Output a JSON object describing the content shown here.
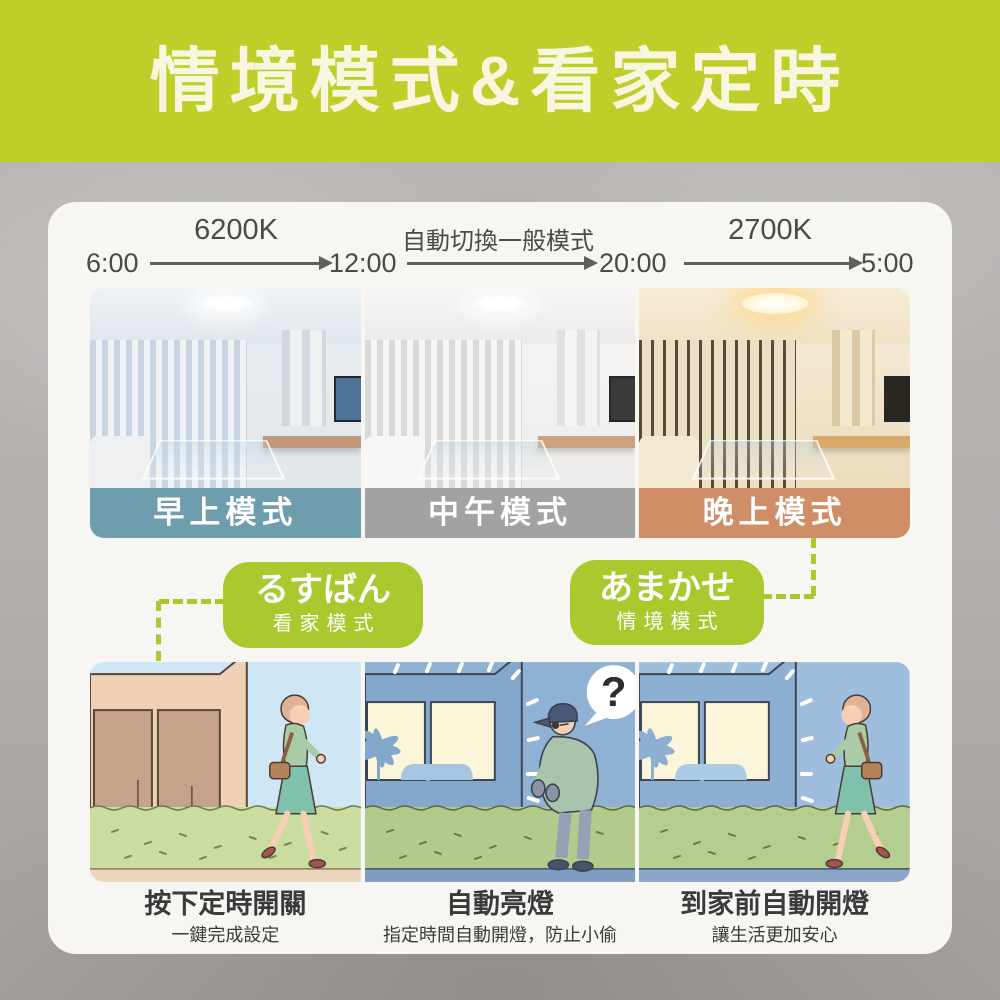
{
  "header": {
    "title": "情境模式&看家定時"
  },
  "timeline": {
    "times": [
      "6:00",
      "12:00",
      "20:00",
      "5:00"
    ],
    "segments": [
      "6200K",
      "自動切換一般模式",
      "2700K"
    ]
  },
  "modes": [
    {
      "label": "早上模式",
      "color": "#6e9dae"
    },
    {
      "label": "中午模式",
      "color": "#a2a2a2"
    },
    {
      "label": "晚上模式",
      "color": "#cf8e66"
    }
  ],
  "bubbles": [
    {
      "title": "るすばん",
      "subtitle": "看家模式"
    },
    {
      "title": "あまかせ",
      "subtitle": "情境模式"
    }
  ],
  "scenes": [
    {
      "caption": "按下定時開關",
      "subcaption": "一鍵完成設定"
    },
    {
      "caption": "自動亮燈",
      "subcaption": "指定時間自動開燈，防止小偷",
      "callout": "?"
    },
    {
      "caption": "到家前自動開燈",
      "subcaption": "讓生活更加安心"
    }
  ],
  "colors": {
    "banner_green": "#bdd02a",
    "bubble_green": "#a9c92f",
    "card_white": "#f7f6f3",
    "background_gray": "#b2afad",
    "morning_label": "#6e9dae",
    "noon_label": "#a2a2a2",
    "evening_label": "#cf8e66"
  }
}
